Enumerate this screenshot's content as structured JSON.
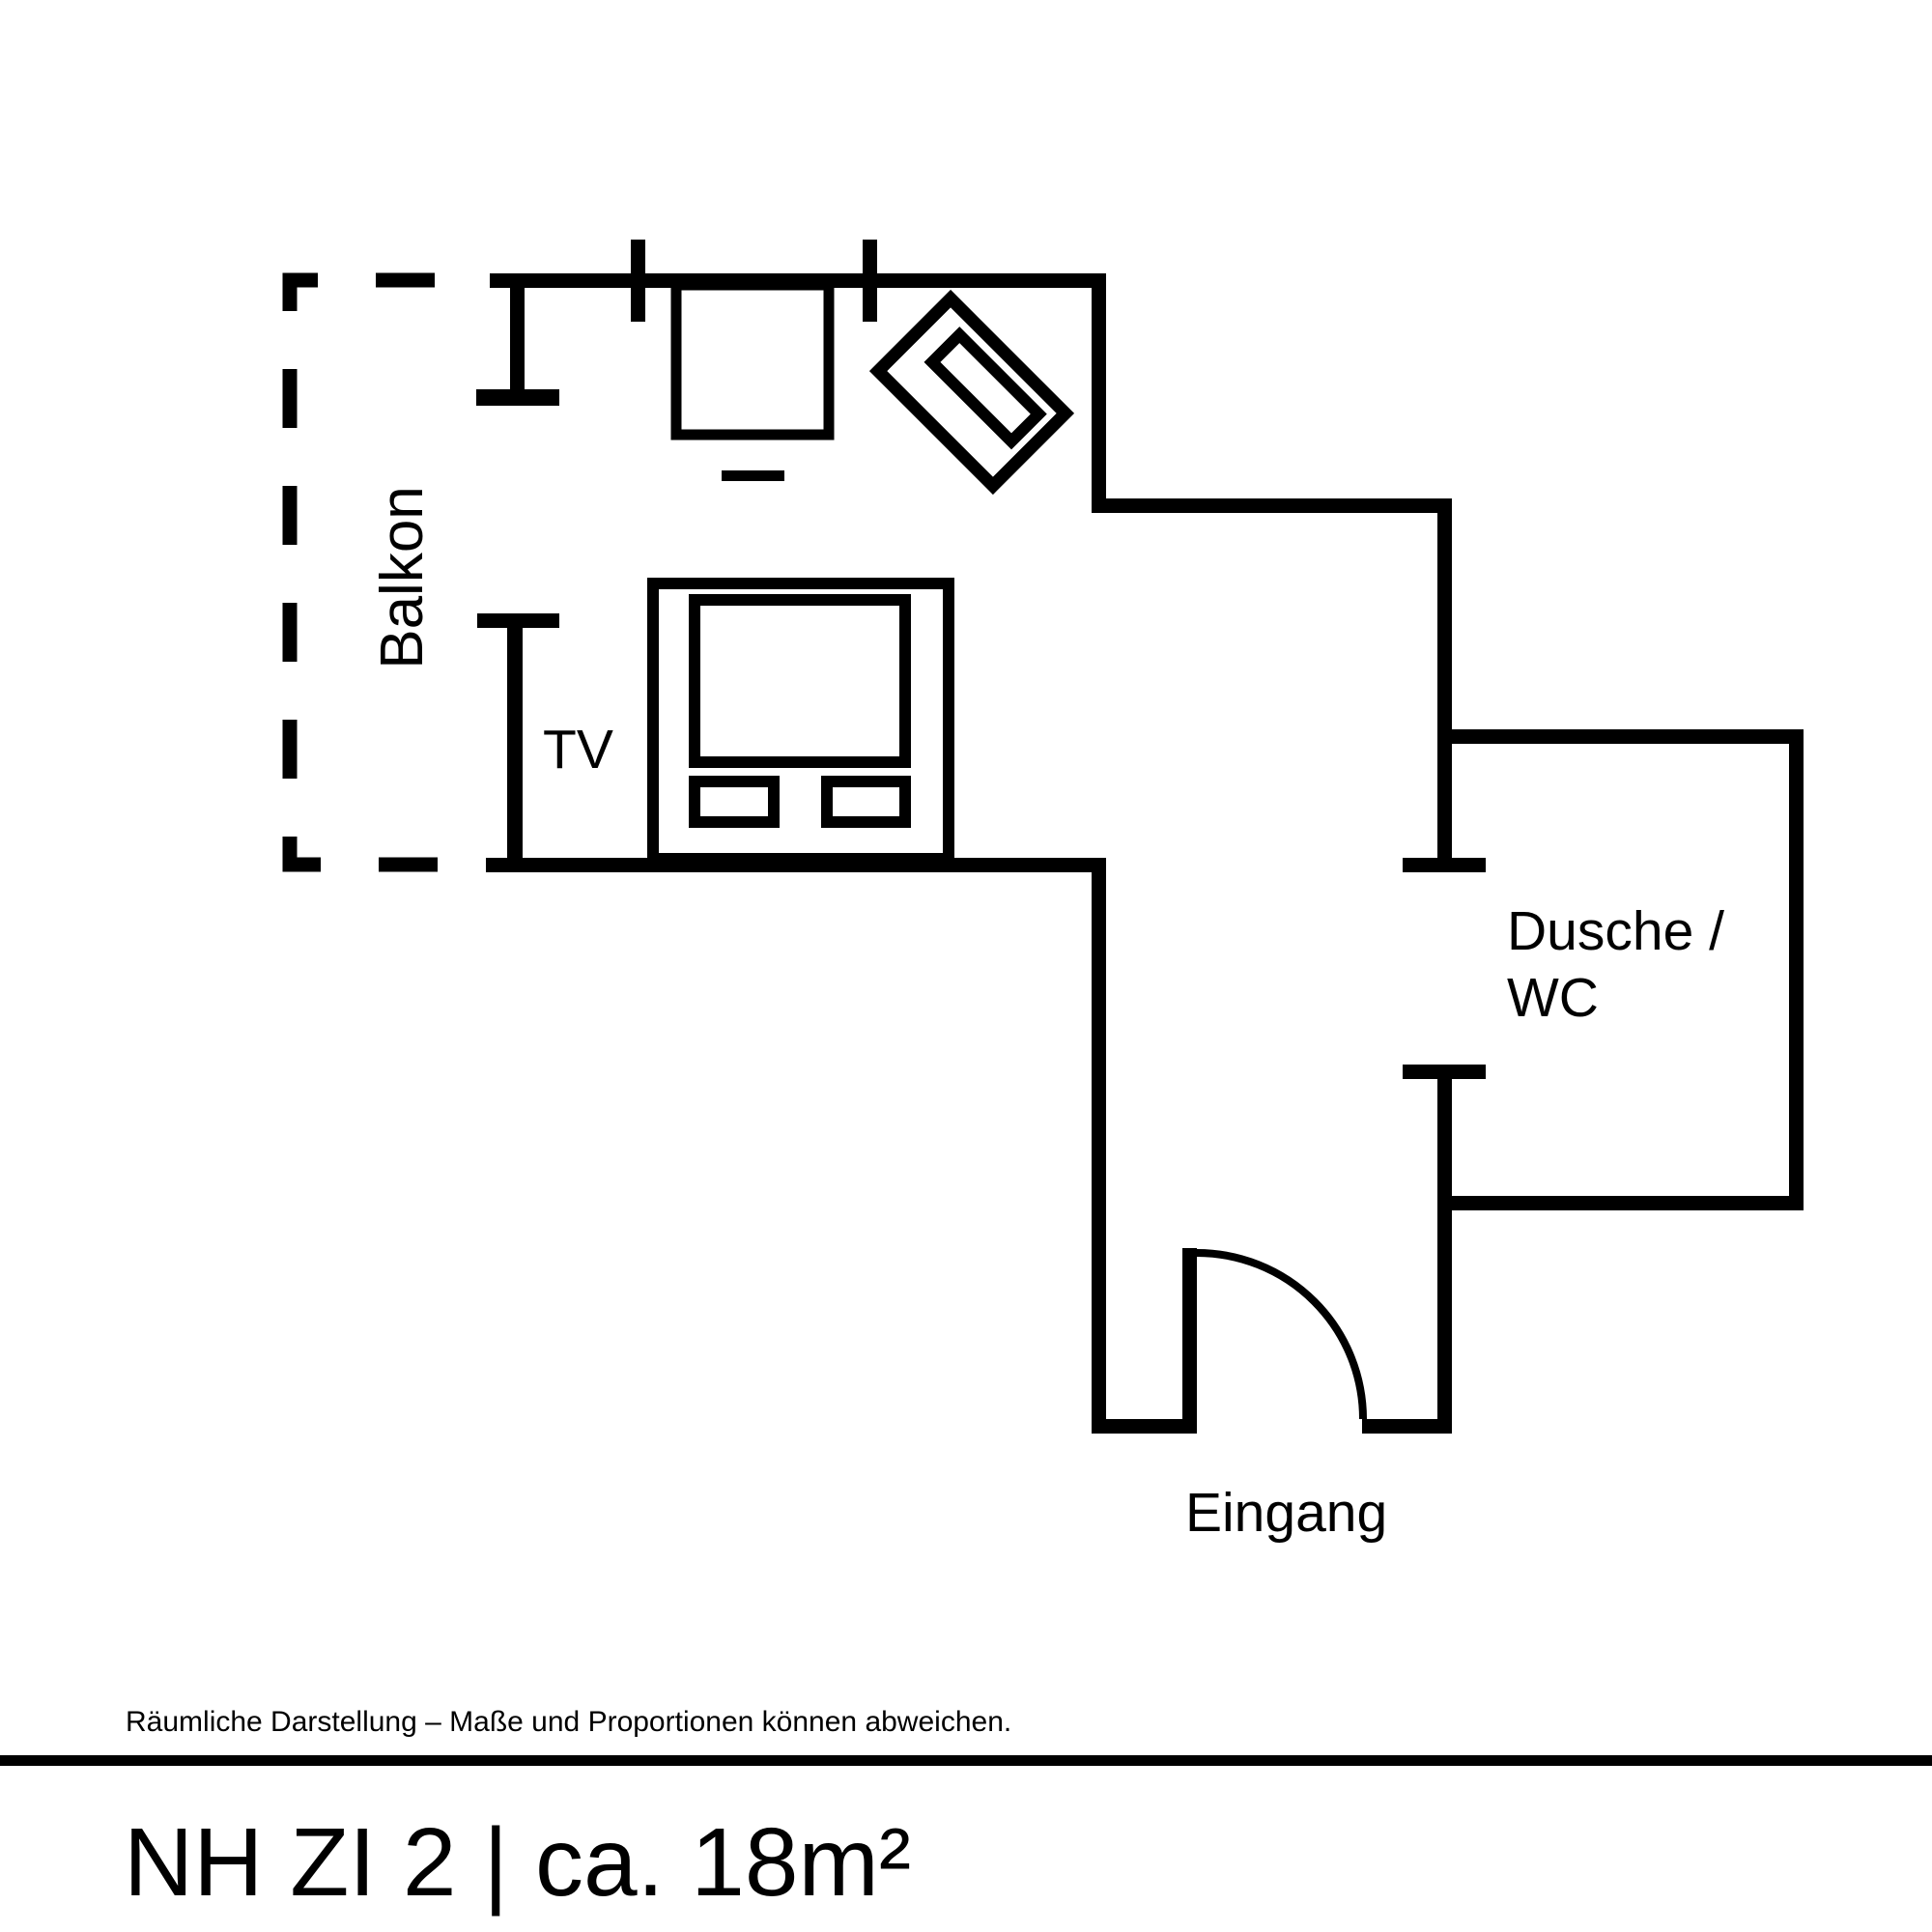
{
  "page": {
    "background_color": "#ffffff",
    "line_color": "#000000"
  },
  "floorplan": {
    "labels": {
      "balcony": "Balkon",
      "tv": "TV",
      "bathroom_line1": "Dusche /",
      "bathroom_line2": "WC",
      "entrance": "Eingang"
    },
    "footer": {
      "disclaimer": "Räumliche Darstellung – Maße und Proportionen können abweichen."
    },
    "title": {
      "text": "NH ZI 2 | ca. 18m²"
    }
  }
}
